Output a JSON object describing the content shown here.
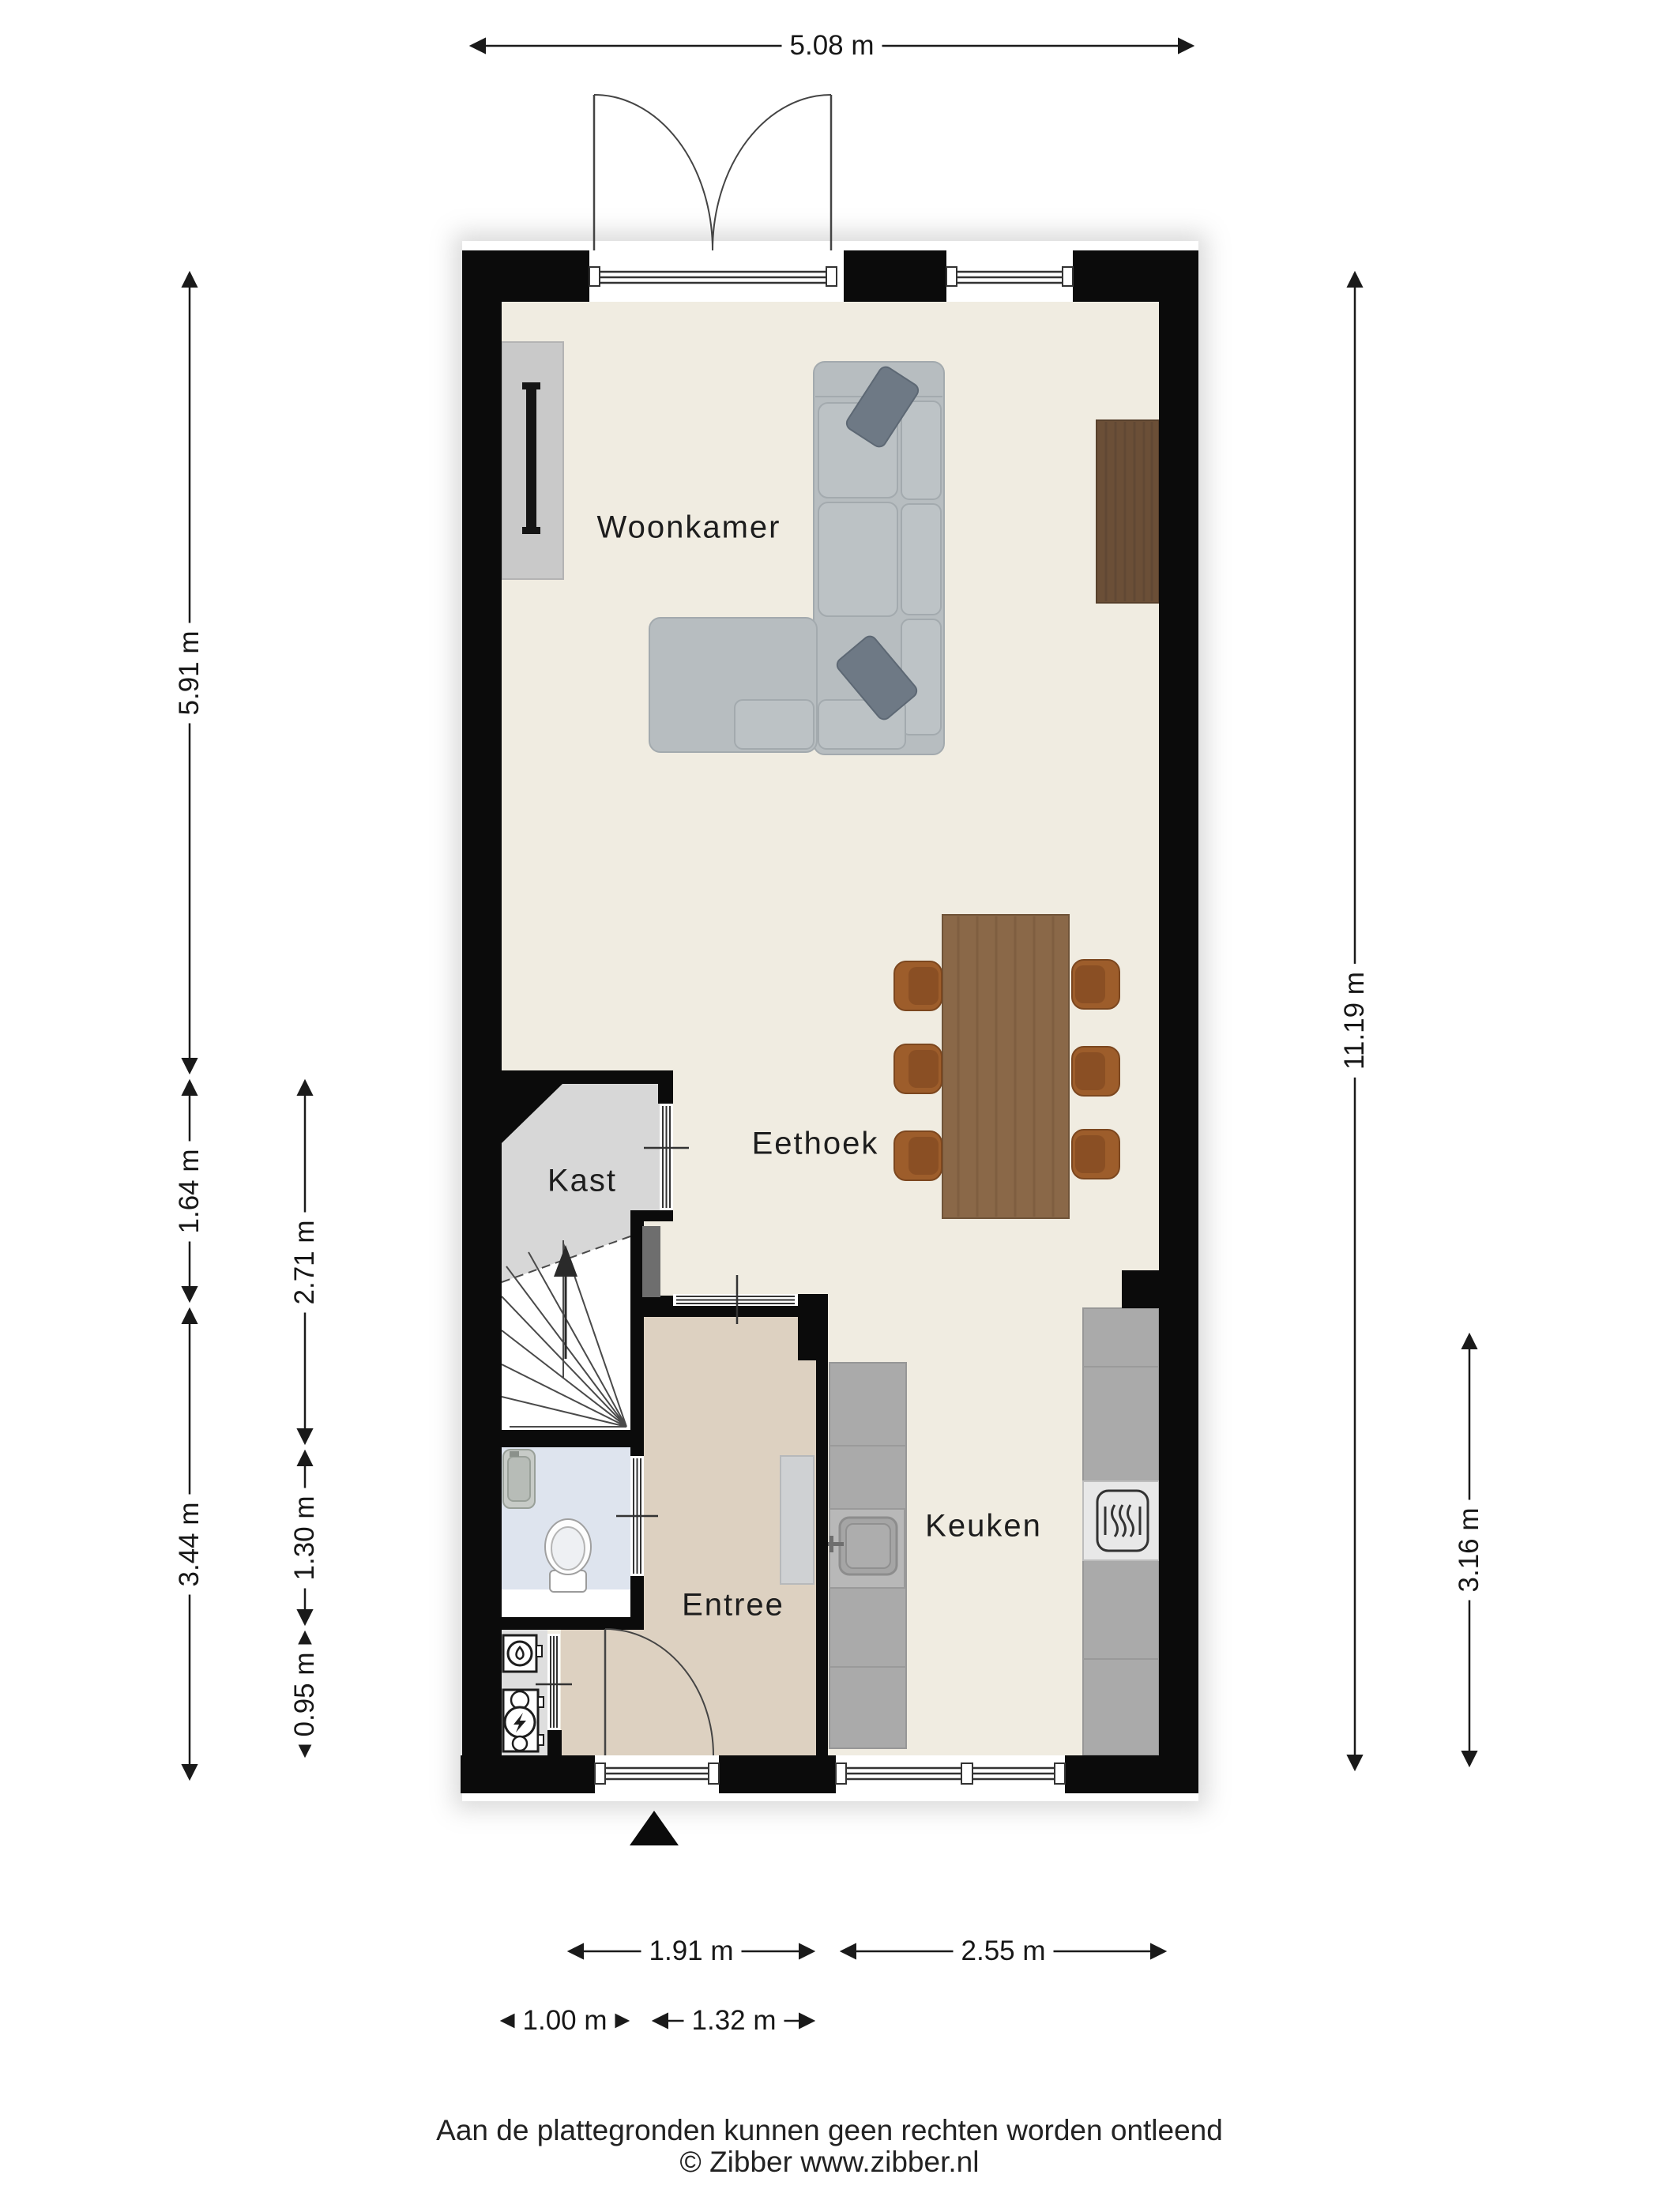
{
  "rooms": {
    "woonkamer": "Woonkamer",
    "eethoek": "Eethoek",
    "kast": "Kast",
    "entree": "Entree",
    "keuken": "Keuken"
  },
  "dimensions": {
    "top_width": "5.08 m",
    "left_outer": [
      "5.91 m",
      "1.64 m",
      "3.44 m"
    ],
    "left_inner": [
      "2.71 m",
      "1.30 m",
      "0.95 m"
    ],
    "right_total": "11.19 m",
    "right_kitchen": "3.16 m",
    "bottom_upper": [
      "1.91 m",
      "2.55 m"
    ],
    "bottom_lower": [
      "1.00 m",
      "1.32 m"
    ]
  },
  "footer": {
    "disclaimer": "Aan de plattegronden kunnen geen rechten worden ontleend",
    "copyright": "© Zibber www.zibber.nl"
  },
  "icons": {
    "north_marker": "solid-triangle-up",
    "stairs_up_arrow": "arrow-up",
    "water_meter": "circle-with-drop",
    "electric_meter": "circle-with-lightning",
    "stove": "rounded-square-heat-waves",
    "sink": "basin-with-faucet",
    "toilet": "bowl-with-cistern",
    "tv": "wall-mounted-tv-bar"
  },
  "colors": {
    "wall": "#0b0b0b",
    "floor_main": "#f0ece1",
    "floor_entree": "#ddd1c1",
    "floor_toilet": "#dee4ee",
    "floor_kast": "#d7d7d7",
    "floor_meter": "#dedede",
    "counter": "#aaaaaa",
    "wood_sideboard": "#6b4f37",
    "wood_table": "#8a6848",
    "chair": "#9d5d2b",
    "sofa": "#b7bdc0",
    "pillow": "#6e7985",
    "dimension_line": "#1a1a1a"
  }
}
